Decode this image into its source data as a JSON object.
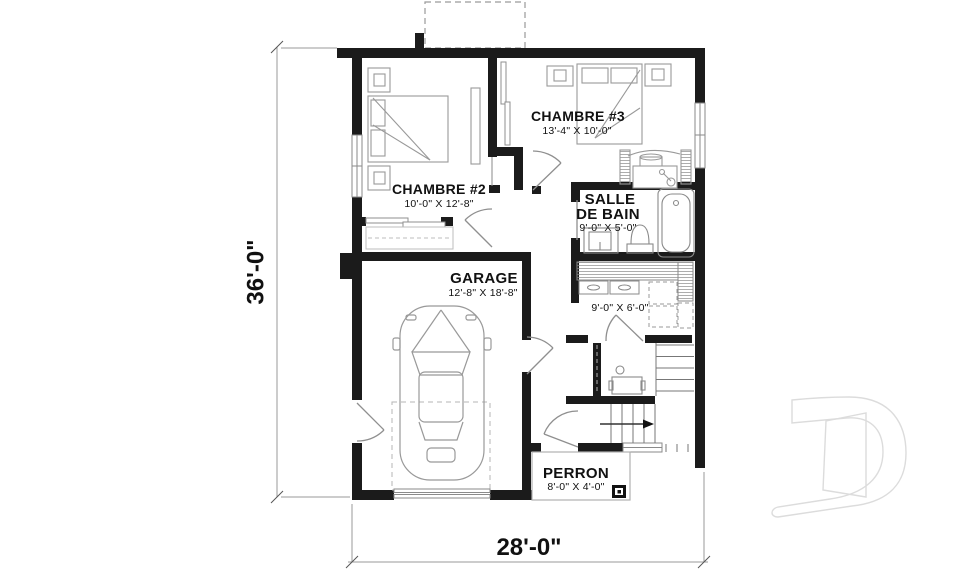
{
  "rooms": {
    "chambre3": {
      "name": "CHAMBRE #3",
      "dims": "13'-4\" X 10'-0\""
    },
    "chambre2": {
      "name": "CHAMBRE #2",
      "dims": "10'-0\" X 12'-8\""
    },
    "salle_de_bain": {
      "name_line1": "SALLE",
      "name_line2": "DE BAIN",
      "dims": "9'-0\" X 5'-0\""
    },
    "garage": {
      "name": "GARAGE",
      "dims": "12'-8\" X 18'-8\""
    },
    "utility": {
      "dims": "9'-0\" X 6'-0\""
    },
    "perron": {
      "name": "PERRON",
      "dims": "8'-0\" X 4'-0\""
    }
  },
  "dimensions": {
    "height": "36'-0\"",
    "width": "28'-0\""
  },
  "watermark": {
    "letter": "D"
  },
  "colors": {
    "wall": "#1b1b1b",
    "furniture_line": "#909090",
    "dimension_text": "#111111",
    "watermark_outline": "#dcdcdc"
  }
}
